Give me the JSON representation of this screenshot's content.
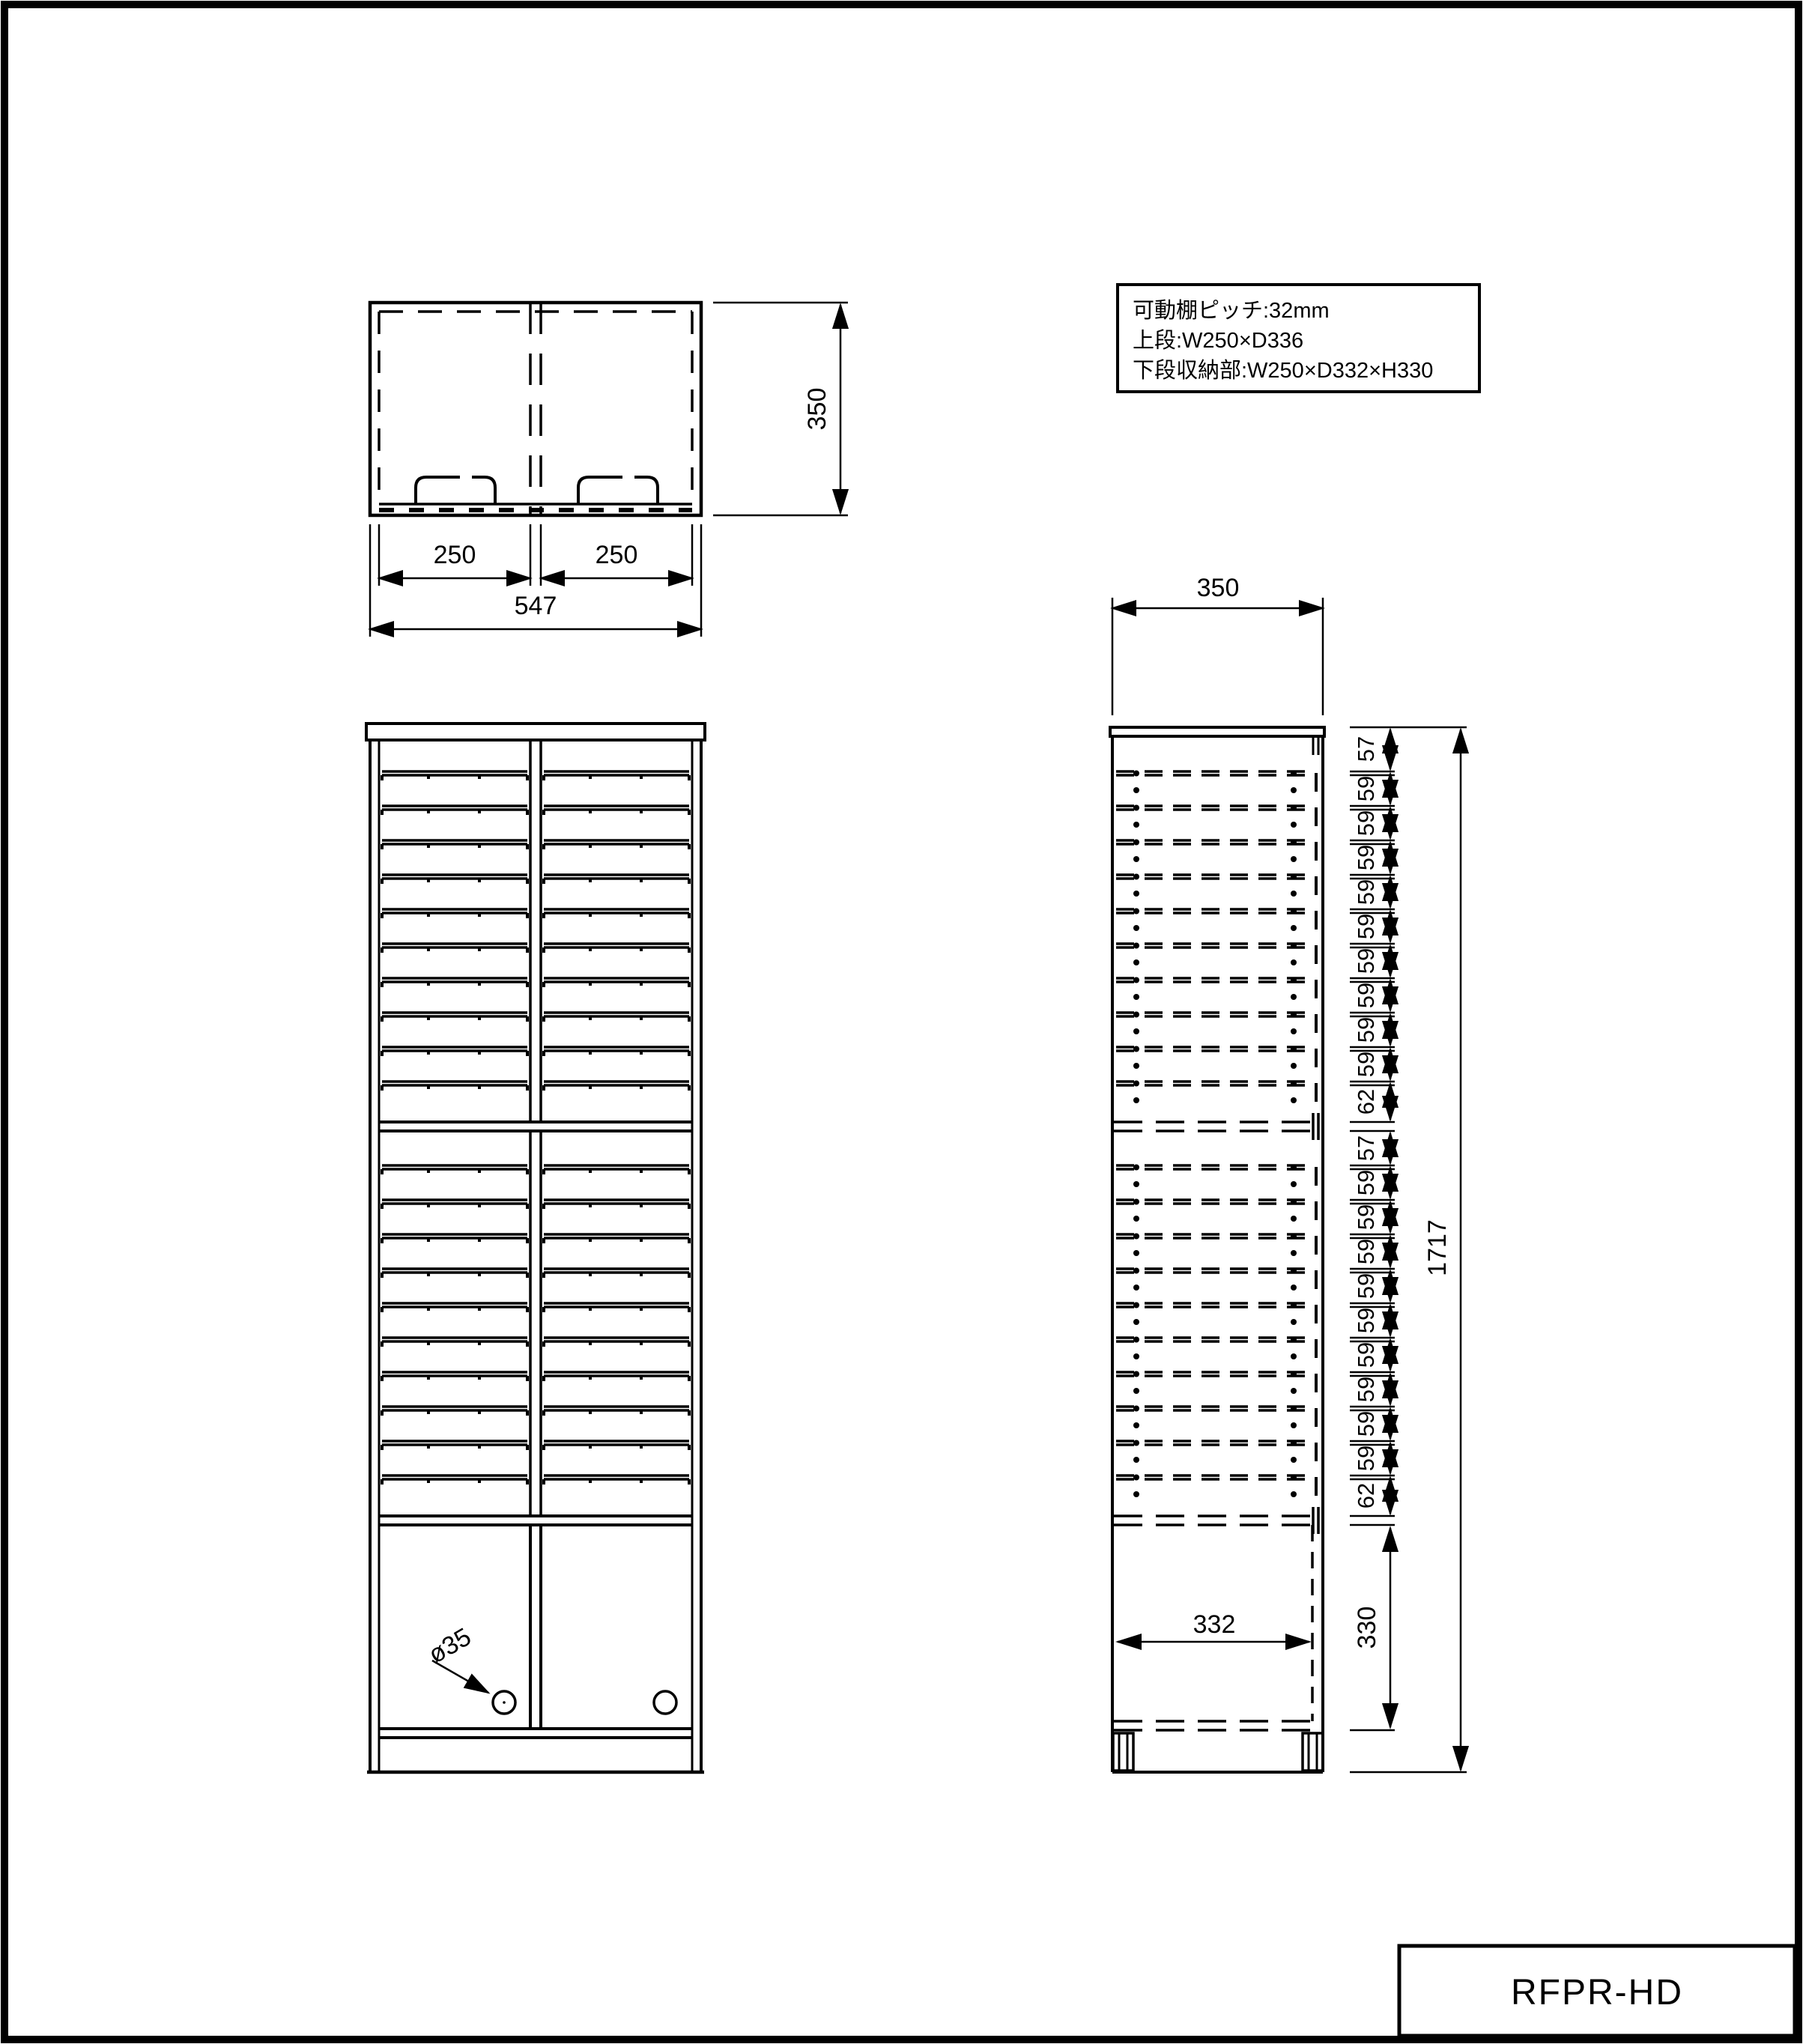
{
  "page": {
    "title_block": "RFPR-HD"
  },
  "info_box": {
    "line1": "可動棚ピッチ:32mm",
    "line2": "上段:W250×D336",
    "line3": "下段収納部:W250×D332×H330"
  },
  "top_view": {
    "bay_left": "250",
    "bay_right": "250",
    "total_width": "547",
    "depth": "350"
  },
  "front_view": {
    "hole_label": "ø35"
  },
  "side_view": {
    "depth": "350",
    "total_height": "1717",
    "inner_depth": "332",
    "storage_height": "330",
    "chain": [
      "57",
      "59",
      "59",
      "59",
      "59",
      "59",
      "59",
      "59",
      "59",
      "59",
      "62",
      "57",
      "59",
      "59",
      "59",
      "59",
      "59",
      "59",
      "59",
      "59",
      "59",
      "62"
    ]
  }
}
